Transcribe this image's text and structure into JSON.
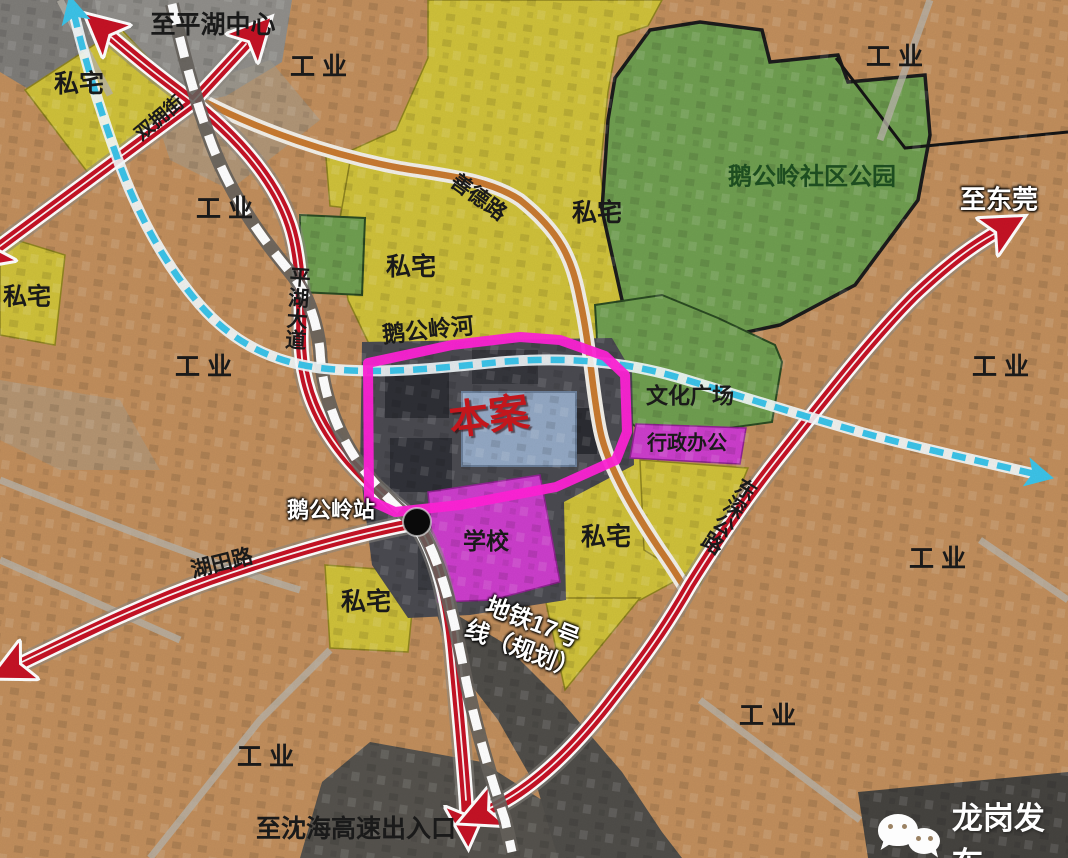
{
  "labels": {
    "to_pinghu_center": "至平湖中心",
    "to_dongguan": "至东莞",
    "to_shenhai_expressway": "至沈海高速出入口",
    "shande_road": "善德路",
    "pinghu_avenue": "平湖大道",
    "shuangyong_street": "双拥街",
    "egongling_river": "鹅公岭河",
    "egongling_station": "鹅公岭站",
    "hutian_road": "湖田路",
    "dongshen_highway": "东深公路",
    "metro_line17_l1": "地铁17号",
    "metro_line17_l2": "线（规划）",
    "site": "本案",
    "culture_square": "文化广场",
    "admin_office": "行政办公",
    "school": "学校",
    "community_park": "鹅公岭社区公园",
    "industrial": "工业",
    "private_housing": "私宅"
  },
  "watermark": {
    "account": "龙岗发布"
  },
  "legend_colors": {
    "industrial": "#c49260",
    "private_housing": "#cfc13a",
    "park_green": "#6f9e50",
    "public_magenta": "#cc3ecc",
    "site_outline": "#ff22d6",
    "road_red": "#c51225",
    "road_orange": "#c87a30",
    "river_cyan": "#3cc3e8",
    "metro_dash_white": "#ffffff"
  }
}
